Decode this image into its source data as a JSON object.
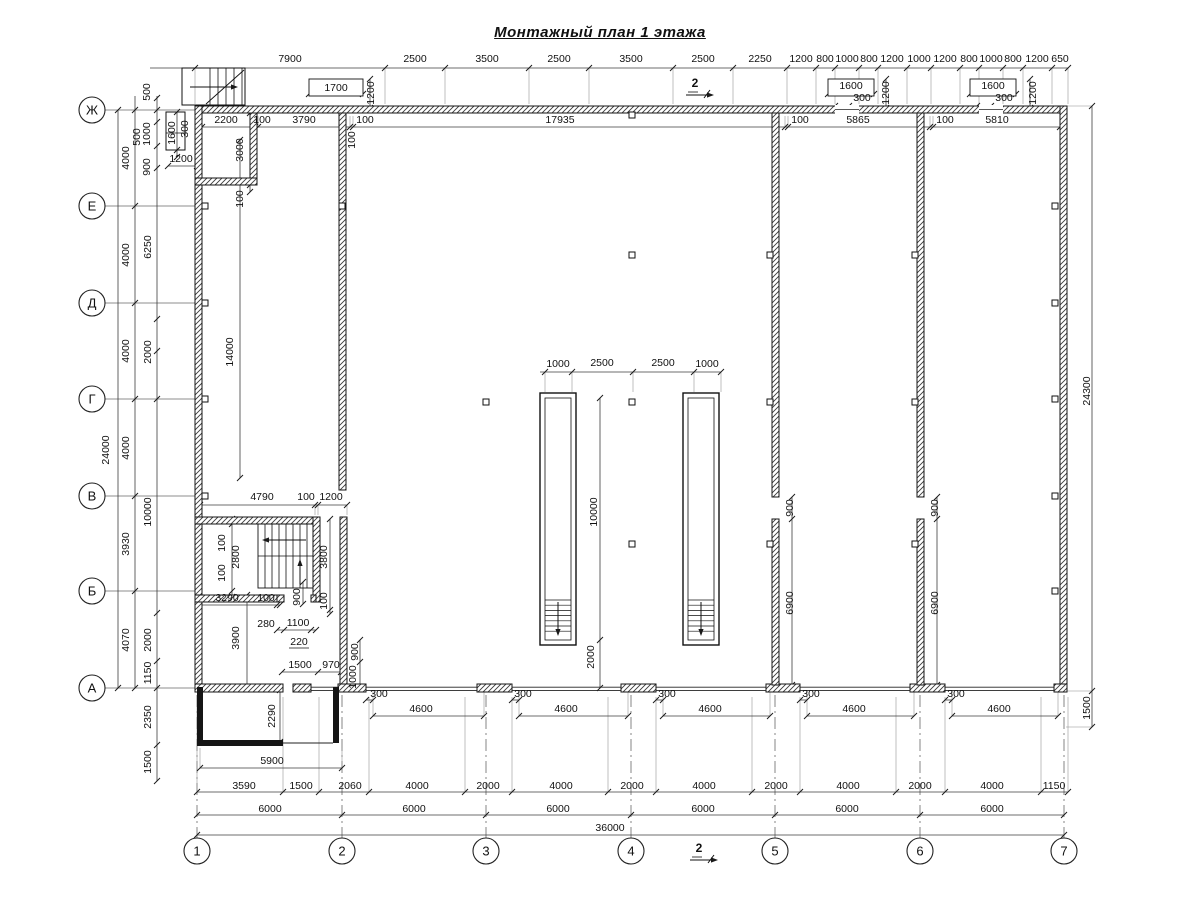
{
  "title": "Монтажный план 1 этажа",
  "section_marker_label": "2",
  "axes_left": [
    {
      "label": "Ж",
      "y": 110
    },
    {
      "label": "Е",
      "y": 206
    },
    {
      "label": "Д",
      "y": 303
    },
    {
      "label": "Г",
      "y": 399
    },
    {
      "label": "В",
      "y": 496
    },
    {
      "label": "Б",
      "y": 591
    },
    {
      "label": "А",
      "y": 688
    }
  ],
  "axes_bottom": [
    {
      "label": "1",
      "x": 197
    },
    {
      "label": "2",
      "x": 342
    },
    {
      "label": "3",
      "x": 486
    },
    {
      "label": "4",
      "x": 631
    },
    {
      "label": "5",
      "x": 775
    },
    {
      "label": "6",
      "x": 920
    },
    {
      "label": "7",
      "x": 1064
    }
  ],
  "colors": {
    "line": "#1a1a1a",
    "dim": "#3c3c3c",
    "ext": "#8a8a8a",
    "axis": "#666666"
  },
  "dim_labels": [
    [
      "7900",
      290,
      62,
      0
    ],
    [
      "2500",
      415,
      62,
      0
    ],
    [
      "3500",
      487,
      62,
      0
    ],
    [
      "2500",
      559,
      62,
      0
    ],
    [
      "3500",
      631,
      62,
      0
    ],
    [
      "2500",
      703,
      62,
      0
    ],
    [
      "2250",
      760,
      62,
      0
    ],
    [
      "1200",
      801,
      62,
      0
    ],
    [
      "800",
      825,
      62,
      0
    ],
    [
      "1000",
      847,
      62,
      0
    ],
    [
      "800",
      869,
      62,
      0
    ],
    [
      "1200",
      892,
      62,
      0
    ],
    [
      "1000",
      919,
      62,
      0
    ],
    [
      "1200",
      945,
      62,
      0
    ],
    [
      "800",
      969,
      62,
      0
    ],
    [
      "1000",
      991,
      62,
      0
    ],
    [
      "800",
      1013,
      62,
      0
    ],
    [
      "1200",
      1037,
      62,
      0
    ],
    [
      "650",
      1060,
      62,
      0
    ],
    [
      "2200",
      226,
      123,
      0
    ],
    [
      "100",
      262,
      123,
      0
    ],
    [
      "3790",
      304,
      123,
      0
    ],
    [
      "100",
      365,
      123,
      0
    ],
    [
      "17935",
      560,
      123,
      0
    ],
    [
      "100",
      800,
      123,
      0
    ],
    [
      "5865",
      858,
      123,
      0
    ],
    [
      "100",
      945,
      123,
      0
    ],
    [
      "5810",
      997,
      123,
      0
    ],
    [
      "1700",
      336,
      91,
      0
    ],
    [
      "1200",
      374,
      93,
      1
    ],
    [
      "1600",
      851,
      89,
      0
    ],
    [
      "300",
      862,
      101,
      0
    ],
    [
      "1200",
      889,
      93,
      1
    ],
    [
      "1600",
      993,
      89,
      0
    ],
    [
      "300",
      1004,
      101,
      0
    ],
    [
      "1200",
      1036,
      93,
      1
    ],
    [
      "24000",
      109,
      450,
      1
    ],
    [
      "4000",
      129,
      158,
      1
    ],
    [
      "4000",
      129,
      255,
      1
    ],
    [
      "4000",
      129,
      351,
      1
    ],
    [
      "4000",
      129,
      448,
      1
    ],
    [
      "3930",
      129,
      544,
      1
    ],
    [
      "4070",
      129,
      640,
      1
    ],
    [
      "500",
      150,
      92,
      1
    ],
    [
      "500",
      140,
      137,
      1
    ],
    [
      "1000",
      150,
      134,
      1
    ],
    [
      "900",
      150,
      167,
      1
    ],
    [
      "1600",
      175,
      133,
      1
    ],
    [
      "300",
      188,
      129,
      1
    ],
    [
      "1200",
      181,
      162,
      0
    ],
    [
      "6250",
      151,
      247,
      1
    ],
    [
      "2000",
      151,
      352,
      1
    ],
    [
      "10000",
      151,
      512,
      1
    ],
    [
      "2000",
      151,
      640,
      1
    ],
    [
      "1150",
      151,
      673,
      1
    ],
    [
      "2350",
      151,
      717,
      1
    ],
    [
      "1500",
      151,
      762,
      1
    ],
    [
      "3000",
      243,
      150,
      1
    ],
    [
      "100",
      243,
      199,
      1
    ],
    [
      "14000",
      233,
      352,
      1
    ],
    [
      "100",
      355,
      140,
      1
    ],
    [
      "4790",
      262,
      500,
      0
    ],
    [
      "100",
      306,
      500,
      0
    ],
    [
      "1200",
      331,
      500,
      0
    ],
    [
      "100",
      225,
      543,
      1
    ],
    [
      "2800",
      239,
      557,
      1
    ],
    [
      "100",
      225,
      573,
      1
    ],
    [
      "3800",
      327,
      557,
      1
    ],
    [
      "100",
      327,
      601,
      1
    ],
    [
      "900",
      300,
      597,
      1
    ],
    [
      "3290",
      227,
      601,
      0
    ],
    [
      "100",
      266,
      601,
      0
    ],
    [
      "280",
      266,
      627,
      0
    ],
    [
      "1100",
      298,
      626,
      0
    ],
    [
      "220",
      299,
      645,
      0
    ],
    [
      "3900",
      239,
      638,
      1
    ],
    [
      "1500",
      300,
      668,
      0
    ],
    [
      "970",
      331,
      668,
      0
    ],
    [
      "900",
      358,
      652,
      1
    ],
    [
      "1000",
      356,
      677,
      1
    ],
    [
      "2290",
      275,
      716,
      1
    ],
    [
      "5900",
      272,
      764,
      0
    ],
    [
      "1000",
      558,
      367,
      0
    ],
    [
      "2500",
      602,
      366,
      0
    ],
    [
      "2500",
      663,
      366,
      0
    ],
    [
      "1000",
      707,
      367,
      0
    ],
    [
      "10000",
      597,
      512,
      1
    ],
    [
      "2000",
      594,
      657,
      1
    ],
    [
      "900",
      793,
      508,
      1
    ],
    [
      "6900",
      793,
      603,
      1
    ],
    [
      "900",
      938,
      508,
      1
    ],
    [
      "6900",
      938,
      603,
      1
    ],
    [
      "24300",
      1090,
      391,
      1
    ],
    [
      "1500",
      1090,
      708,
      1
    ],
    [
      "300",
      379,
      697,
      0
    ],
    [
      "4600",
      421,
      712,
      0
    ],
    [
      "300",
      523,
      697,
      0
    ],
    [
      "4600",
      566,
      712,
      0
    ],
    [
      "300",
      667,
      697,
      0
    ],
    [
      "4600",
      710,
      712,
      0
    ],
    [
      "300",
      811,
      697,
      0
    ],
    [
      "4600",
      854,
      712,
      0
    ],
    [
      "300",
      956,
      697,
      0
    ],
    [
      "4600",
      999,
      712,
      0
    ],
    [
      "3590",
      244,
      789,
      0
    ],
    [
      "1500",
      301,
      789,
      0
    ],
    [
      "2060",
      350,
      789,
      0
    ],
    [
      "4000",
      417,
      789,
      0
    ],
    [
      "2000",
      488,
      789,
      0
    ],
    [
      "4000",
      561,
      789,
      0
    ],
    [
      "2000",
      632,
      789,
      0
    ],
    [
      "4000",
      704,
      789,
      0
    ],
    [
      "2000",
      776,
      789,
      0
    ],
    [
      "4000",
      848,
      789,
      0
    ],
    [
      "2000",
      920,
      789,
      0
    ],
    [
      "4000",
      992,
      789,
      0
    ],
    [
      "1150",
      1054,
      789,
      0
    ],
    [
      "6000",
      270,
      812,
      0
    ],
    [
      "6000",
      414,
      812,
      0
    ],
    [
      "6000",
      558,
      812,
      0
    ],
    [
      "6000",
      703,
      812,
      0
    ],
    [
      "6000",
      847,
      812,
      0
    ],
    [
      "6000",
      992,
      812,
      0
    ],
    [
      "36000",
      610,
      831,
      0
    ]
  ],
  "dim_lines": [
    [
      "h",
      68,
      150,
      1068,
      [
        195,
        385,
        445,
        529,
        589,
        673,
        733,
        787,
        816,
        835,
        859,
        878,
        907,
        931,
        960,
        979,
        1003,
        1023,
        1052,
        1068
      ],
      36
    ],
    [
      "h",
      127,
      202,
      1060,
      [
        202,
        255,
        258,
        350,
        353,
        785,
        788,
        930,
        933,
        1060
      ],
      -11
    ],
    [
      "v",
      118,
      110,
      688,
      [
        110,
        688
      ],
      0
    ],
    [
      "v",
      135,
      96,
      688,
      [
        110,
        206,
        303,
        399,
        496,
        591,
        688
      ],
      0
    ],
    [
      "v",
      157,
      96,
      781,
      [
        98,
        110,
        122,
        146,
        168,
        319,
        351,
        399,
        613,
        661,
        688,
        745,
        781
      ],
      0
    ],
    [
      "h",
      505,
      200,
      347,
      [
        200,
        315,
        318,
        347
      ],
      10
    ],
    [
      "v",
      330,
      519,
      614,
      [
        519,
        610,
        614
      ],
      0
    ],
    [
      "v",
      303,
      582,
      604,
      [
        582,
        604
      ],
      0
    ],
    [
      "h",
      605,
      198,
      280,
      [
        198,
        277,
        280
      ],
      0
    ],
    [
      "h",
      630,
      277,
      316,
      [
        277,
        284,
        311,
        316
      ],
      0
    ],
    [
      "h",
      672,
      282,
      341,
      [
        282,
        318,
        341
      ],
      0
    ],
    [
      "v",
      360,
      640,
      688,
      [
        640,
        662,
        688
      ],
      0
    ],
    [
      "h",
      768,
      200,
      342,
      [
        200,
        342
      ],
      -20
    ],
    [
      "h",
      792,
      197,
      1068,
      [
        197,
        283,
        319,
        369,
        465,
        512,
        608,
        656,
        752,
        800,
        896,
        945,
        1041,
        1068
      ],
      -95
    ],
    [
      "h",
      815,
      197,
      1064,
      [
        197,
        342,
        486,
        631,
        775,
        920,
        1064
      ],
      0
    ],
    [
      "h",
      835,
      197,
      1064,
      [
        197,
        1064
      ],
      0
    ],
    [
      "h",
      372,
      540,
      721,
      [
        545,
        572,
        633,
        694,
        721
      ],
      20
    ],
    [
      "v",
      600,
      398,
      688,
      [
        398,
        640,
        688
      ],
      0
    ],
    [
      "v",
      792,
      497,
      685,
      [
        497,
        519,
        685
      ],
      0
    ],
    [
      "v",
      937,
      497,
      685,
      [
        497,
        519,
        685
      ],
      0
    ],
    [
      "v",
      1092,
      106,
      727,
      [
        106,
        691,
        727
      ],
      -26
    ],
    [
      "v",
      232,
      519,
      597,
      [
        519,
        524,
        591,
        597
      ],
      0
    ],
    [
      "h",
      700,
      366,
      373,
      [
        366,
        373
      ],
      0
    ],
    [
      "h",
      700,
      512,
      519,
      [
        512,
        519
      ],
      0
    ],
    [
      "h",
      700,
      656,
      663,
      [
        656,
        663
      ],
      0
    ],
    [
      "h",
      700,
      800,
      807,
      [
        800,
        807
      ],
      0
    ],
    [
      "h",
      700,
      945,
      952,
      [
        945,
        952
      ],
      0
    ],
    [
      "h",
      716,
      373,
      484,
      [
        373,
        484
      ],
      -26
    ],
    [
      "h",
      716,
      519,
      628,
      [
        519,
        628
      ],
      -26
    ],
    [
      "h",
      716,
      663,
      770,
      [
        663,
        770
      ],
      -26
    ],
    [
      "h",
      716,
      807,
      914,
      [
        807,
        914
      ],
      -26
    ],
    [
      "h",
      716,
      952,
      1058,
      [
        952,
        1058
      ],
      -26
    ],
    [
      "v",
      280,
      690,
      742,
      [
        690,
        742
      ],
      0
    ],
    [
      "v",
      177,
      112,
      157,
      [
        112,
        150,
        157
      ],
      0
    ],
    [
      "h",
      166,
      168,
      197,
      [
        168,
        197
      ],
      0
    ],
    [
      "v",
      370,
      79,
      108,
      [
        79,
        108
      ],
      0
    ],
    [
      "v",
      886,
      79,
      108,
      [
        79,
        108
      ],
      0
    ],
    [
      "v",
      1030,
      79,
      108,
      [
        79,
        108
      ],
      0
    ],
    [
      "v",
      250,
      113,
      192,
      [
        113,
        185,
        192
      ],
      0
    ],
    [
      "v",
      240,
      140,
      478,
      [
        140,
        478
      ],
      0
    ],
    [
      "v",
      247,
      595,
      689,
      [
        595,
        689
      ],
      0
    ],
    [
      "h",
      94,
      828,
      874,
      [
        828,
        874
      ],
      0
    ],
    [
      "h",
      106,
      835,
      849,
      [
        835,
        849
      ],
      0
    ],
    [
      "h",
      94,
      970,
      1016,
      [
        970,
        1016
      ],
      0
    ],
    [
      "h",
      106,
      977,
      991,
      [
        977,
        991
      ],
      0
    ],
    [
      "h",
      94,
      309,
      363,
      [
        309,
        363
      ],
      0
    ]
  ],
  "walls_hatched": [
    [
      195,
      106,
      872,
      7
    ],
    [
      195,
      106,
      7,
      585
    ],
    [
      1060,
      106,
      7,
      585
    ],
    [
      195,
      684,
      88,
      8
    ],
    [
      293,
      684,
      18,
      8
    ],
    [
      338,
      684,
      28,
      8
    ],
    [
      477,
      684,
      35,
      8
    ],
    [
      621,
      684,
      35,
      8
    ],
    [
      766,
      684,
      34,
      8
    ],
    [
      910,
      684,
      35,
      8
    ],
    [
      1054,
      684,
      13,
      8
    ],
    [
      339,
      113,
      7,
      377
    ],
    [
      772,
      113,
      7,
      384
    ],
    [
      772,
      519,
      7,
      166
    ],
    [
      917,
      113,
      7,
      384
    ],
    [
      917,
      519,
      7,
      166
    ],
    [
      250,
      113,
      7,
      72
    ],
    [
      195,
      178,
      62,
      7
    ],
    [
      195,
      517,
      125,
      7
    ],
    [
      313,
      517,
      7,
      85
    ],
    [
      195,
      595,
      82,
      7
    ],
    [
      340,
      517,
      7,
      167
    ],
    [
      277,
      595,
      7,
      7
    ],
    [
      311,
      595,
      5,
      7
    ]
  ],
  "wall_openings": [
    [
      835,
      105,
      24,
      9
    ],
    [
      979,
      105,
      24,
      9
    ]
  ],
  "gates": [
    [
      311,
      338
    ],
    [
      366,
      477
    ],
    [
      512,
      621
    ],
    [
      656,
      766
    ],
    [
      800,
      910
    ],
    [
      945,
      1054
    ]
  ],
  "walls_solid": [
    [
      197,
      687,
      6,
      58
    ],
    [
      197,
      740,
      86,
      6
    ],
    [
      333,
      687,
      6,
      56
    ]
  ],
  "dock_lines": [
    [
      283,
      743,
      333,
      743
    ]
  ],
  "pits": [
    [
      540,
      393,
      36,
      252
    ],
    [
      683,
      393,
      36,
      252
    ]
  ],
  "columns": [
    [
      632,
      115
    ],
    [
      632,
      255
    ],
    [
      632,
      402
    ],
    [
      632,
      544
    ],
    [
      486,
      402
    ],
    [
      770,
      255
    ],
    [
      770,
      402
    ],
    [
      770,
      544
    ],
    [
      915,
      255
    ],
    [
      915,
      402
    ],
    [
      915,
      544
    ],
    [
      205,
      206
    ],
    [
      205,
      303
    ],
    [
      205,
      399
    ],
    [
      205,
      496
    ],
    [
      1055,
      206
    ],
    [
      1055,
      303
    ],
    [
      1055,
      399
    ],
    [
      1055,
      496
    ],
    [
      1055,
      591
    ],
    [
      342,
      206
    ]
  ],
  "stair_exterior": [
    182,
    68,
    63,
    37
  ],
  "stair_interior": [
    258,
    524,
    55,
    64
  ],
  "shaft": [
    166,
    112,
    19,
    38
  ],
  "vent_boxes": [
    [
      309,
      79,
      54,
      17
    ],
    [
      828,
      79,
      46,
      17
    ],
    [
      970,
      79,
      46,
      17
    ]
  ],
  "section_markers": [
    [
      700,
      84
    ],
    [
      704,
      849
    ]
  ]
}
